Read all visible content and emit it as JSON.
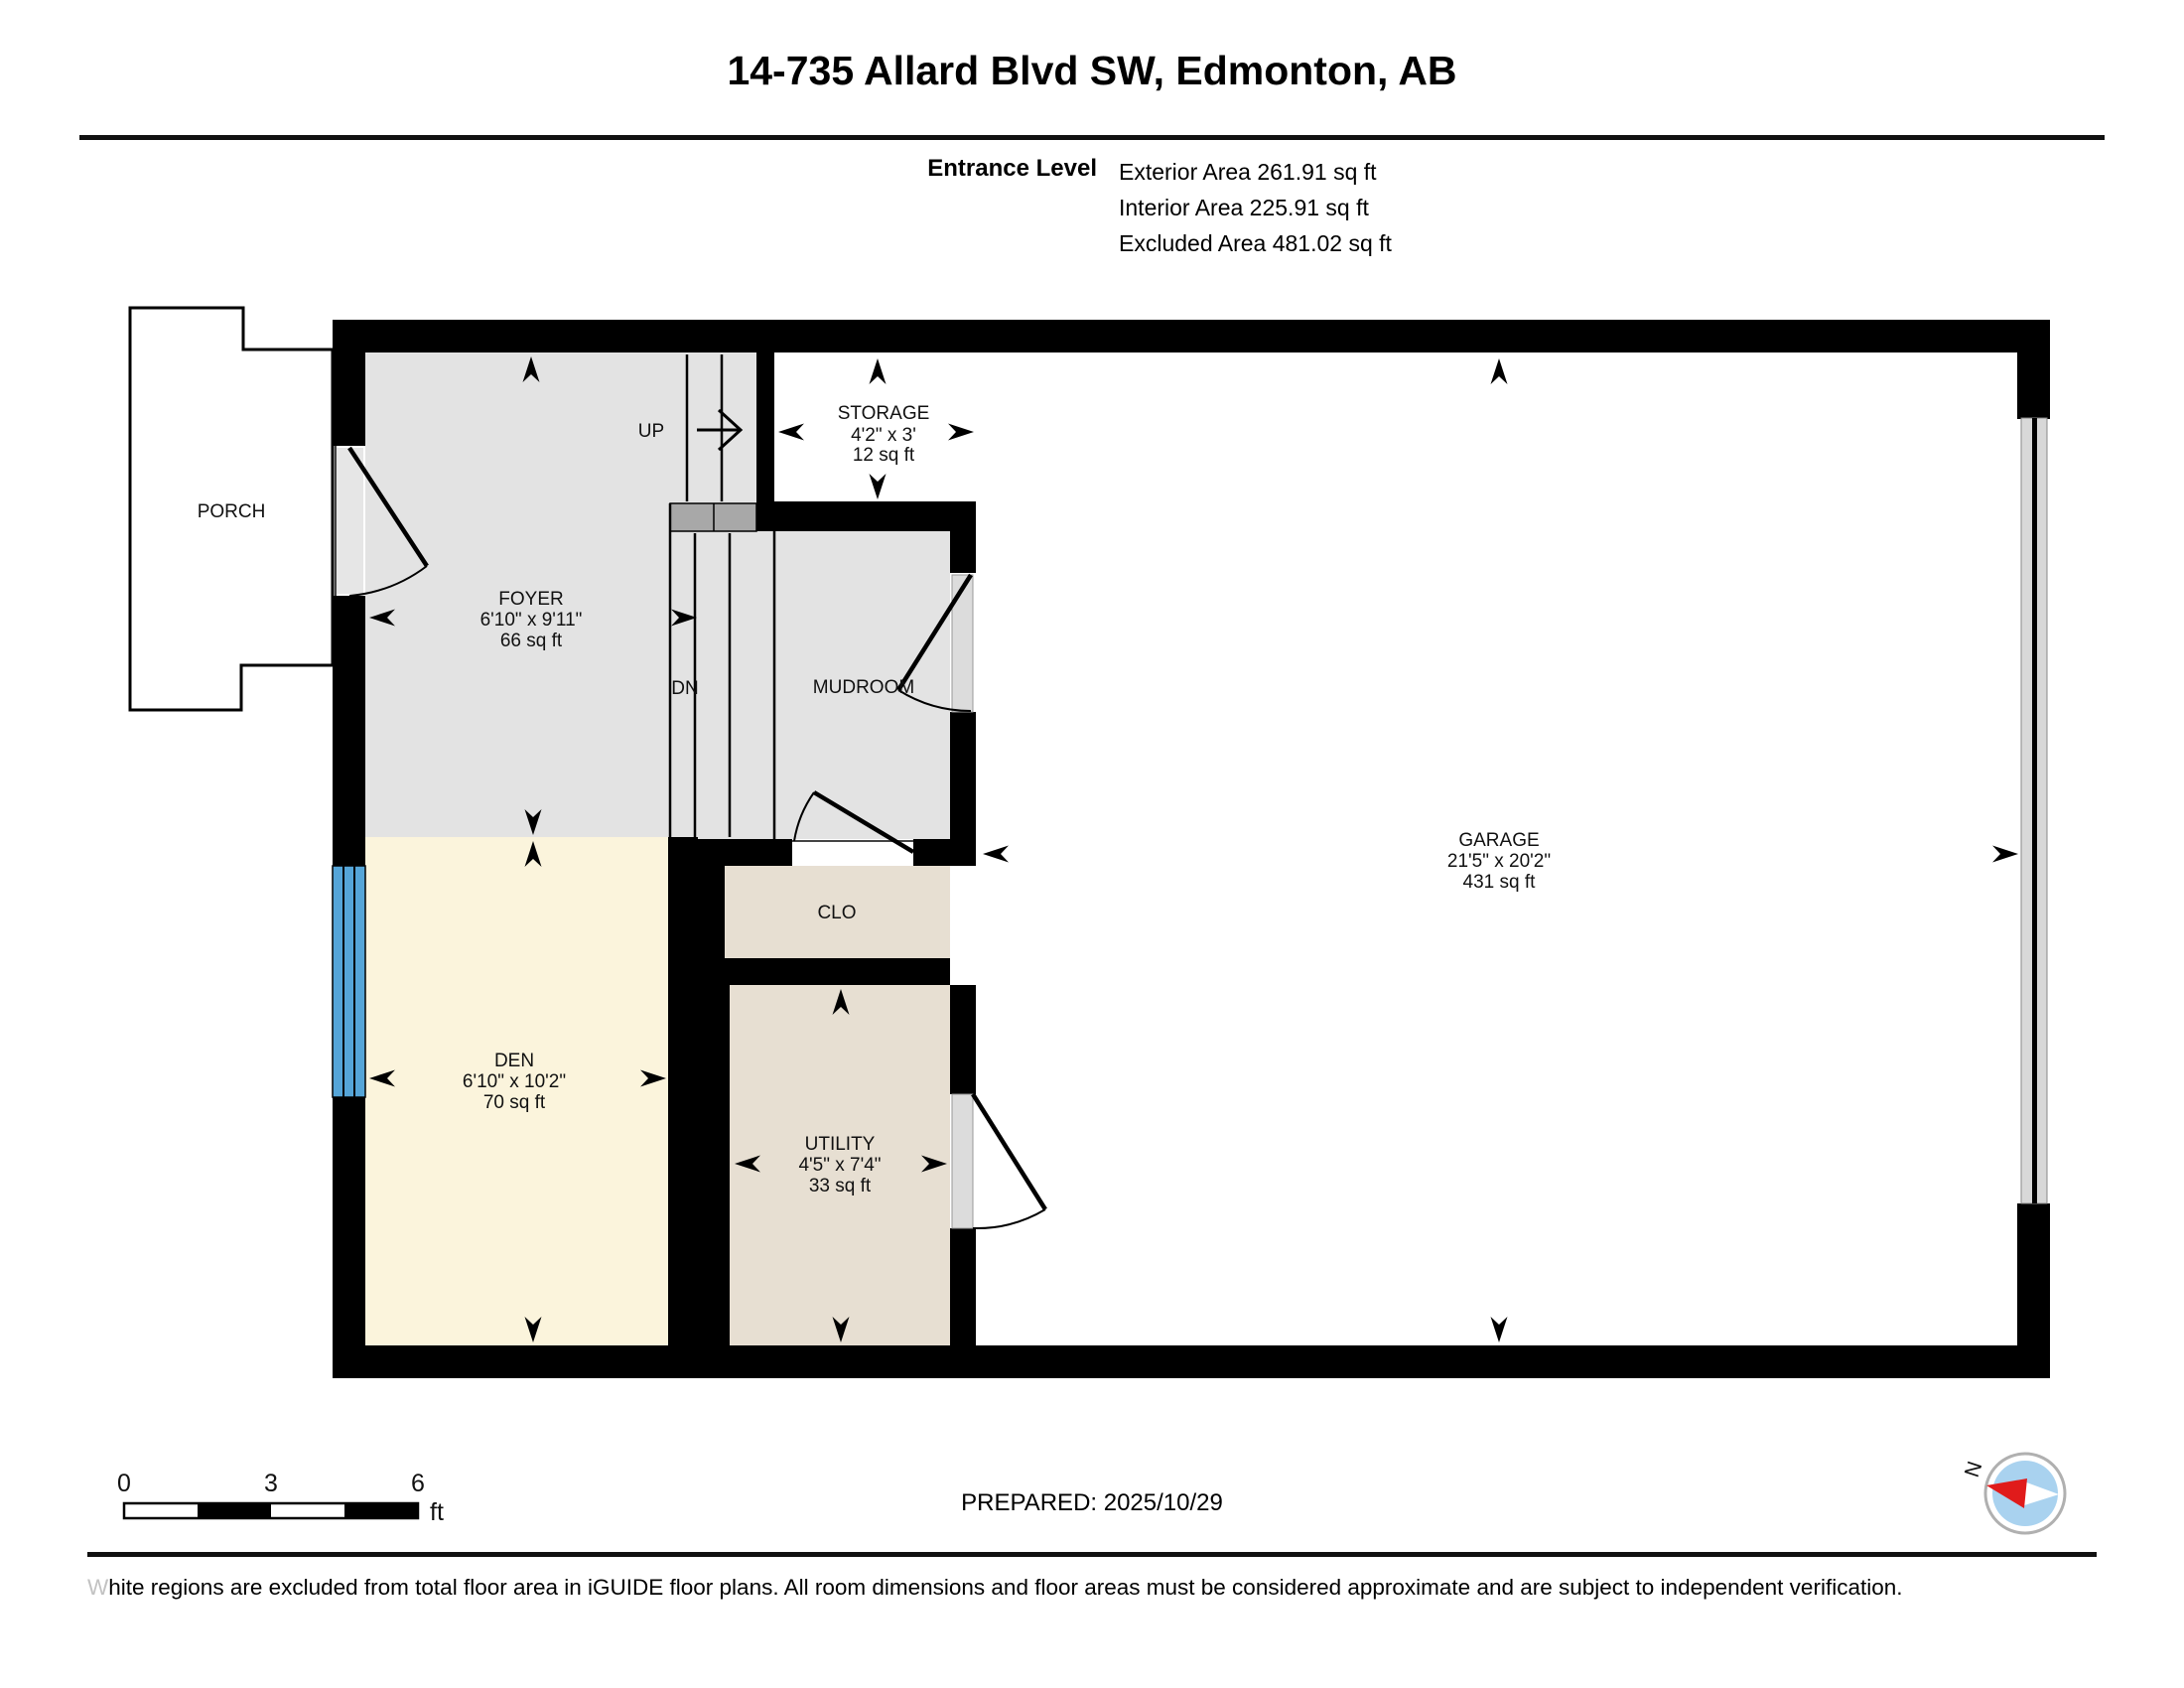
{
  "header": {
    "title": "14-735 Allard Blvd SW, Edmonton, AB",
    "level_name": "Entrance Level",
    "areas": [
      "Exterior Area 261.91 sq ft",
      "Interior Area 225.91 sq ft",
      "Excluded Area 481.02 sq ft"
    ]
  },
  "rooms": {
    "porch": {
      "name": "PORCH"
    },
    "foyer": {
      "name": "FOYER",
      "dims": "6'10\" x 9'11\"",
      "area": "66 sq ft"
    },
    "storage": {
      "name": "STORAGE",
      "dims": "4'2\" x 3'",
      "area": "12 sq ft"
    },
    "mudroom": {
      "name": "MUDROOM"
    },
    "garage": {
      "name": "GARAGE",
      "dims": "21'5\" x 20'2\"",
      "area": "431 sq ft"
    },
    "clo": {
      "name": "CLO"
    },
    "den": {
      "name": "DEN",
      "dims": "6'10\" x 10'2\"",
      "area": "70 sq ft"
    },
    "utility": {
      "name": "UTILITY",
      "dims": "4'5\" x 7'4\"",
      "area": "33 sq ft"
    }
  },
  "stairs": {
    "up": "UP",
    "down": "DN"
  },
  "scale_bar": {
    "tick0": "0",
    "tick3": "3",
    "tick6": "6",
    "unit": "ft"
  },
  "compass": {
    "north_label": "N"
  },
  "footer": {
    "prepared": "PREPARED: 2025/10/29",
    "disclaimer": "White regions are excluded from total floor area in iGUIDE floor plans. All room dimensions and floor areas must be considered approximate and are subject to independent verification."
  },
  "colors": {
    "wall_black": "#000000",
    "floor_gray": "#e3e3e3",
    "floor_cream": "#fbf4dc",
    "floor_tan": "#e7dfd2",
    "landing_gray": "#a8a8a8",
    "window_blue": "#55a5d8",
    "garage_door_gray": "#d8d8d8",
    "compass_red": "#e01b1b",
    "compass_blue": "#a9d2ef"
  }
}
